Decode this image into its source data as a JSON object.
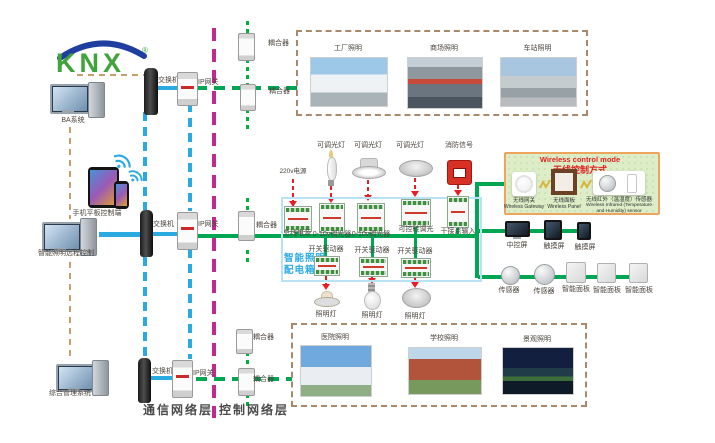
{
  "logo": {
    "text": "KNX",
    "reg": "®"
  },
  "computers": {
    "pc1": "BA系统",
    "pc2": "智能照明远程控制",
    "pc3": "综合管理系统",
    "mobile": "手机平板控制端"
  },
  "layers": {
    "comm": "通信网络层",
    "ctrl": "控制网络层"
  },
  "network": {
    "switches": [
      "交换机",
      "交换机",
      "交换机"
    ],
    "gateways": [
      "IP网关",
      "IP网关",
      "IP网关"
    ],
    "couplers": [
      "耦合器",
      "耦合器",
      "耦合器",
      "耦合器",
      "耦合器"
    ]
  },
  "zones_top": {
    "z1": "工厂照明",
    "z2": "商场照明",
    "z3": "车站照明"
  },
  "zones_bottom": {
    "z1": "医院照明",
    "z2": "学校照明",
    "z3": "景观照明"
  },
  "cabinet": {
    "title1": "智能照明",
    "title2": "配电箱",
    "power": "220v电源",
    "loads_top": [
      "可调光灯",
      "可调光灯",
      "可调光灯",
      "消防信号"
    ],
    "row1": [
      "总线电源",
      "0-10v调光器",
      "0-10v调光器",
      "可控硅调光",
      "干接点输入"
    ],
    "row2": [
      "开关驱动器",
      "开关驱动器",
      "开关驱动器"
    ],
    "loads_bottom": [
      "照明灯",
      "照明灯",
      "照明灯"
    ]
  },
  "wireless": {
    "title_en": "Wireless control mode",
    "title_cn": "无线控制方式",
    "gateway_cn": "无线网关",
    "gateway_en": "Wireless Gateway",
    "panel_cn": "无线面板",
    "panel_en": "Wireless Panel",
    "sensor_cn": "无线红外（温湿度）传感器",
    "sensor_en": "Wireless Infrared (Temperature and Humidity) sensor"
  },
  "right": {
    "screens": [
      "中控屏",
      "触摸屏",
      "触摸屏"
    ],
    "sensors": [
      "传感器",
      "传感器"
    ],
    "panels": [
      "智能面板",
      "智能面板",
      "智能面板"
    ]
  },
  "colors": {
    "green": "#00a651",
    "blue": "#29abe2",
    "magenta": "#bf2a8b",
    "red": "#ed1c24",
    "tan": "#c3a06e"
  }
}
